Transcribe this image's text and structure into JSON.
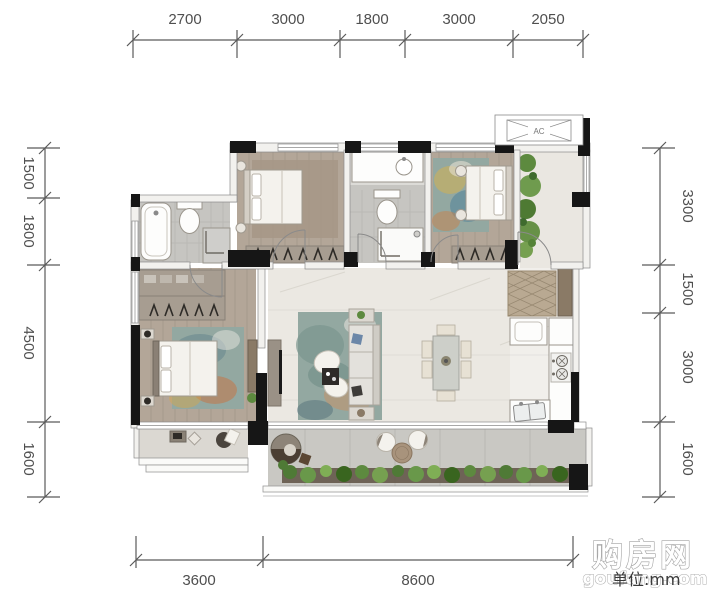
{
  "unit_label": "单位:mm",
  "watermark": {
    "brand": "购房网",
    "domain": "goufang.com"
  },
  "ac_label": "AC",
  "dimensions": {
    "top": [
      "2700",
      "3000",
      "1800",
      "3000",
      "2050"
    ],
    "left": [
      "1500",
      "1800",
      "4500",
      "1600"
    ],
    "right": [
      "3300",
      "1500",
      "3000",
      "1600"
    ],
    "bottom": [
      "3600",
      "8600"
    ]
  },
  "colors": {
    "wall_black": "#161616",
    "wood_floor": "#b3a698",
    "marble_floor": "#ebe8e2",
    "foyer_floor": "#eae7e1",
    "kitchen_floor": "#f1efeb",
    "tile_floor": "#c6c5c1",
    "balcony_floor": "#c9c8c3",
    "small_balcony_floor": "#dbd8d2",
    "rug_teal": "#93a8a1",
    "rug_accent_orange": "#c07a4e",
    "rug_accent_yellow": "#d9b24a",
    "plant_green": "#5d8a3f",
    "dimension_ink": "#4f4f4f"
  }
}
